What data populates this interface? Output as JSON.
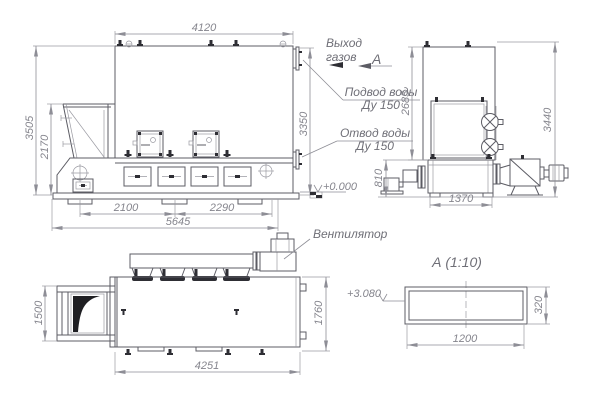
{
  "drawing": {
    "views": {
      "front": {
        "dims": {
          "width": "4120",
          "total_height": "3505",
          "hopper_height": "2170",
          "body_height": "3350",
          "span_a": "2100",
          "span_b": "2290",
          "total_length": "5645"
        }
      },
      "side": {
        "dims": {
          "upper_height": "2685",
          "total_height": "3440",
          "base_height": "810",
          "depth": "1370"
        },
        "level_mark": "+0.000"
      },
      "plan": {
        "dims": {
          "hopper_width": "1500",
          "body_width": "1760",
          "length": "4251"
        }
      },
      "detail": {
        "title": "А (1:10)",
        "dims": {
          "width": "1200",
          "height": "320"
        },
        "level_mark": "+3.080"
      }
    },
    "labels": {
      "gas_outlet_l1": "Выход",
      "gas_outlet_l2": "газов",
      "view_letter": "А",
      "water_supply_l1": "Подвод воды",
      "water_supply_l2": "Ду 150",
      "water_return_l1": "Отвод воды",
      "water_return_l2": "Ду 150",
      "fan": "Вентилятор"
    },
    "colors": {
      "outline": "#5c5c64",
      "dimension": "#8e8e96",
      "text_dim": "#85858d",
      "text_label": "#6f6f77",
      "fill_dark": "#2e2e34",
      "background": "#ffffff"
    }
  }
}
